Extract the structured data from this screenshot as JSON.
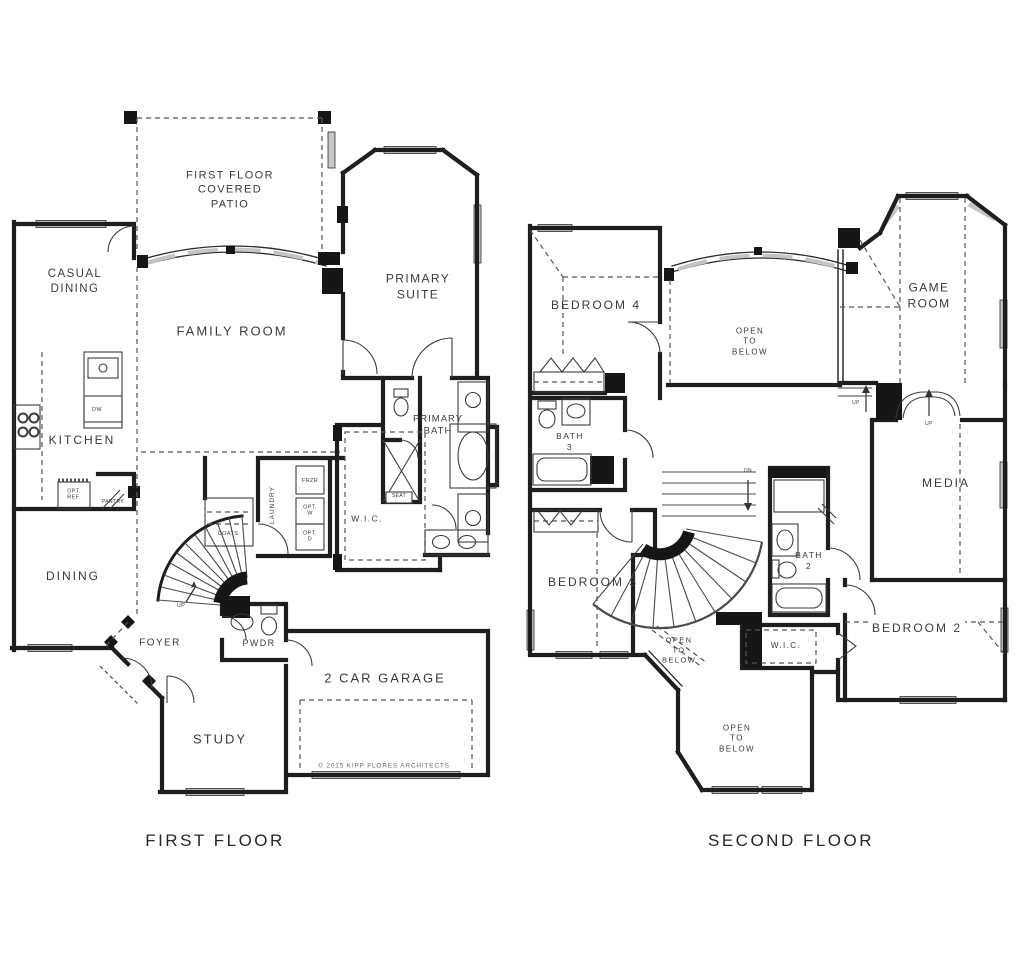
{
  "captions": {
    "first_floor": "FIRST FLOOR",
    "second_floor": "SECOND FLOOR"
  },
  "copyright": "© 2015 KIPP FLORES ARCHITECTS",
  "first_floor": {
    "patio": "FIRST FLOOR\nCOVERED\nPATIO",
    "casual_dining": "CASUAL\nDINING",
    "family_room": "FAMILY ROOM",
    "primary_suite": "PRIMARY\nSUITE",
    "kitchen": "KITCHEN",
    "dw": "DW",
    "opt_ref": "OPT.\nREF.",
    "pantry": "PANTRY",
    "frzr": "FRZR",
    "opt_w": "OPT.\nW",
    "opt_d": "OPT.\nD",
    "laundry": "LAUNDRY",
    "coats": "COATS",
    "primary_bath": "PRIMARY\nBATH",
    "seat": "SEAT",
    "wic": "W.I.C.",
    "dining": "DINING",
    "up": "UP",
    "foyer": "FOYER",
    "pwdr": "PWDR",
    "study": "STUDY",
    "garage": "2 CAR GARAGE"
  },
  "second_floor": {
    "bedroom4": "BEDROOM 4",
    "open_to_below_top": "OPEN\nTO\nBELOW",
    "game_room": "GAME\nROOM",
    "bath3": "BATH\n3",
    "up_left": "UP",
    "up_right": "UP",
    "dn": "DN",
    "media": "MEDIA",
    "bedroom3": "BEDROOM 3",
    "bath2": "BATH\n2",
    "open_to_below_mid": "OPEN\nTO\nBELOW",
    "wic": "W.I.C.",
    "bedroom2": "BEDROOM 2",
    "open_to_below_bottom": "OPEN\nTO\nBELOW"
  }
}
